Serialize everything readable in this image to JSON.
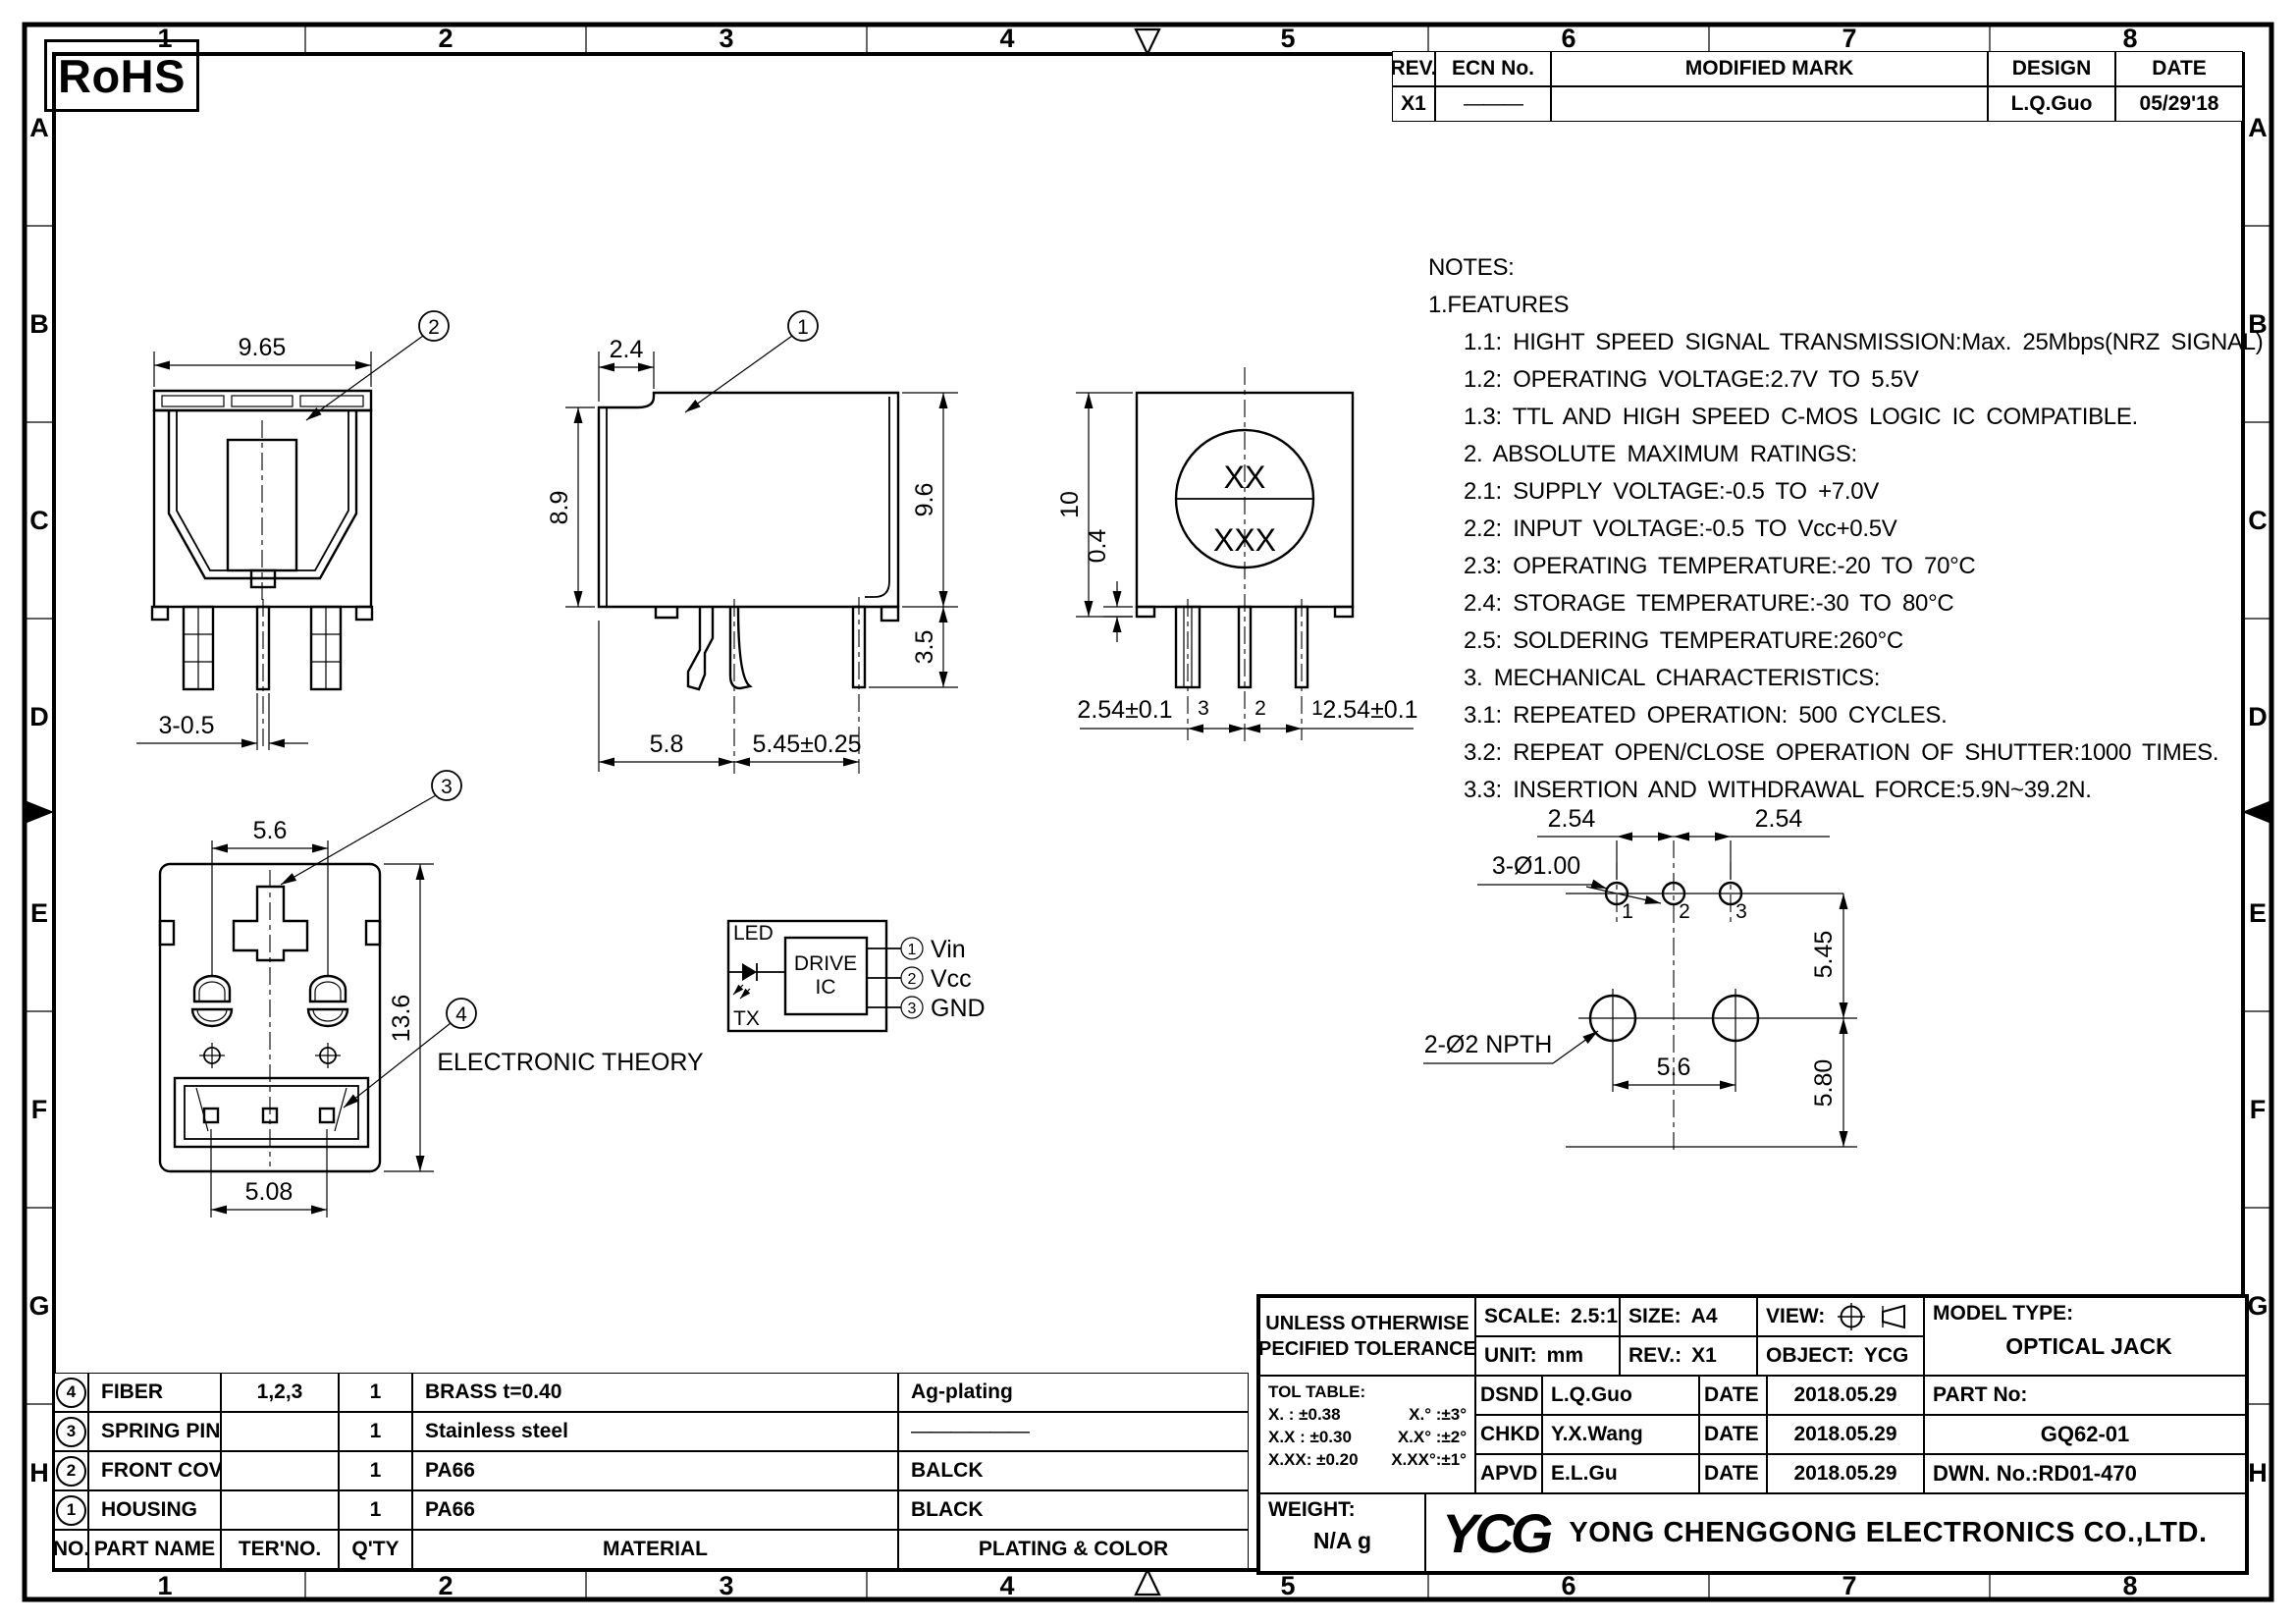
{
  "sheet": {
    "rohs_label": "RoHS",
    "zones_horizontal": [
      "1",
      "2",
      "3",
      "4",
      "5",
      "6",
      "7",
      "8"
    ],
    "zones_vertical": [
      "A",
      "B",
      "C",
      "D",
      "E",
      "F",
      "G",
      "H"
    ]
  },
  "revision_table": {
    "headers": {
      "rev": "REV.",
      "ecn": "ECN No.",
      "mark": "MODIFIED MARK",
      "design": "DESIGN",
      "date": "DATE"
    },
    "row": {
      "rev": "X1",
      "ecn": "———",
      "mark": "",
      "design": "L.Q.Guo",
      "date": "05/29'18"
    }
  },
  "notes": {
    "lines": [
      "NOTES:",
      "1.FEATURES",
      "1.1: HIGHT SPEED SIGNAL TRANSMISSION:Max. 25Mbps(NRZ SIGNAL)",
      "1.2: OPERATING VOLTAGE:2.7V TO 5.5V",
      "1.3: TTL AND HIGH SPEED C-MOS LOGIC IC COMPATIBLE.",
      "2. ABSOLUTE MAXIMUM RATINGS:",
      "2.1: SUPPLY VOLTAGE:-0.5 TO +7.0V",
      "2.2: INPUT VOLTAGE:-0.5 TO Vcc+0.5V",
      "2.3: OPERATING TEMPERATURE:-20 TO 70°C",
      "2.4: STORAGE TEMPERATURE:-30 TO 80°C",
      "2.5: SOLDERING TEMPERATURE:260°C",
      "3. MECHANICAL CHARACTERISTICS:",
      "3.1: REPEATED OPERATION: 500 CYCLES.",
      "3.2: REPEAT OPEN/CLOSE OPERATION OF SHUTTER:1000 TIMES.",
      "3.3: INSERTION AND WITHDRAWAL FORCE:5.9N~39.2N."
    ]
  },
  "views": {
    "front": {
      "balloon": "2",
      "dim_width": "9.65",
      "dim_pin": "3-0.5"
    },
    "side": {
      "balloon": "1",
      "dim_notch": "2.4",
      "dim_body_height": "8.9",
      "dim_total_height": "9.6",
      "dim_pin_length": "3.5",
      "dim_left_span": "5.8",
      "dim_right_span": "5.45±0.25"
    },
    "rear": {
      "mark_line1": "XX",
      "mark_line2": "XXX",
      "dim_height": "10",
      "dim_standoff": "0.4",
      "dim_pitch_left": "2.54±0.1",
      "dim_pitch_right": "2.54±0.1",
      "pin_labels": [
        "3",
        "2",
        "1"
      ]
    },
    "bottom": {
      "balloon_top": "3",
      "balloon_bottom": "4",
      "dim_top": "5.6",
      "dim_height": "13.6",
      "dim_bottom": "5.08"
    },
    "theory": {
      "led_label": "LED",
      "tx_label": "TX",
      "ic_line1": "DRIVE",
      "ic_line2": "IC",
      "caption": "ELECTRONIC THEORY",
      "pins": [
        {
          "num": "1",
          "name": "Vin"
        },
        {
          "num": "2",
          "name": "Vcc"
        },
        {
          "num": "3",
          "name": "GND"
        }
      ]
    },
    "pcb": {
      "dim_pitch_left": "2.54",
      "dim_pitch_right": "2.54",
      "label_small_holes": "3-Ø1.00",
      "label_big_holes": "2-Ø2 NPTH",
      "dim_vertical_top": "5.45",
      "dim_vertical_bottom": "5.80",
      "dim_hole_span": "5.6",
      "hole_labels": [
        "1",
        "2",
        "3"
      ]
    }
  },
  "parts_table": {
    "headers": {
      "no": "NO.",
      "part": "PART NAME",
      "ter": "TER'NO.",
      "qty": "Q'TY",
      "material": "MATERIAL",
      "plating": "PLATING & COLOR"
    },
    "rows": [
      {
        "no": "4",
        "part": "FIBER",
        "ter": "1,2,3",
        "qty": "1",
        "material": "BRASS  t=0.40",
        "plating": "Ag-plating"
      },
      {
        "no": "3",
        "part": "SPRING PIN",
        "ter": "",
        "qty": "1",
        "material": "Stainless steel",
        "plating": "——————"
      },
      {
        "no": "2",
        "part": "FRONT COVER",
        "ter": "",
        "qty": "1",
        "material": "PA66",
        "plating": "BALCK"
      },
      {
        "no": "1",
        "part": "HOUSING",
        "ter": "",
        "qty": "1",
        "material": "PA66",
        "plating": "BLACK"
      }
    ]
  },
  "title_block": {
    "tolerance_note_line1": "UNLESS OTHERWISE",
    "tolerance_note_line2": "SPECIFIED TOLERANCES",
    "scale_label": "SCALE:",
    "scale_value": "2.5:1",
    "size_label": "SIZE:",
    "size_value": "A4",
    "view_label": "VIEW:",
    "model_type_label": "MODEL TYPE:",
    "model_type_value": "OPTICAL JACK",
    "unit_label": "UNIT:",
    "unit_value": "mm",
    "rev_label": "REV.:",
    "rev_value": "X1",
    "object_label": "OBJECT:",
    "object_value": "YCG",
    "tol_table_title": "TOL TABLE:",
    "tol_rows": [
      {
        "linear": "X.   : ±0.38",
        "angular": "X.°   :±3°"
      },
      {
        "linear": "X.X : ±0.30",
        "angular": "X.X° :±2°"
      },
      {
        "linear": "X.XX: ±0.20",
        "angular": "X.XX°:±1°"
      }
    ],
    "approvals": [
      {
        "role": "DSND",
        "name": "L.Q.Guo",
        "date_label": "DATE",
        "date": "2018.05.29"
      },
      {
        "role": "CHKD",
        "name": "Y.X.Wang",
        "date_label": "DATE",
        "date": "2018.05.29"
      },
      {
        "role": "APVD",
        "name": "E.L.Gu",
        "date_label": "DATE",
        "date": "2018.05.29"
      }
    ],
    "part_no_label": "PART No:",
    "part_no_value": "GQ62-01",
    "dwn_no": "DWN. No.:RD01-470",
    "weight_label": "WEIGHT:",
    "weight_value": "N/A  g",
    "logo_text": "YCG",
    "company_name": "YONG CHENGGONG ELECTRONICS CO.,LTD."
  }
}
